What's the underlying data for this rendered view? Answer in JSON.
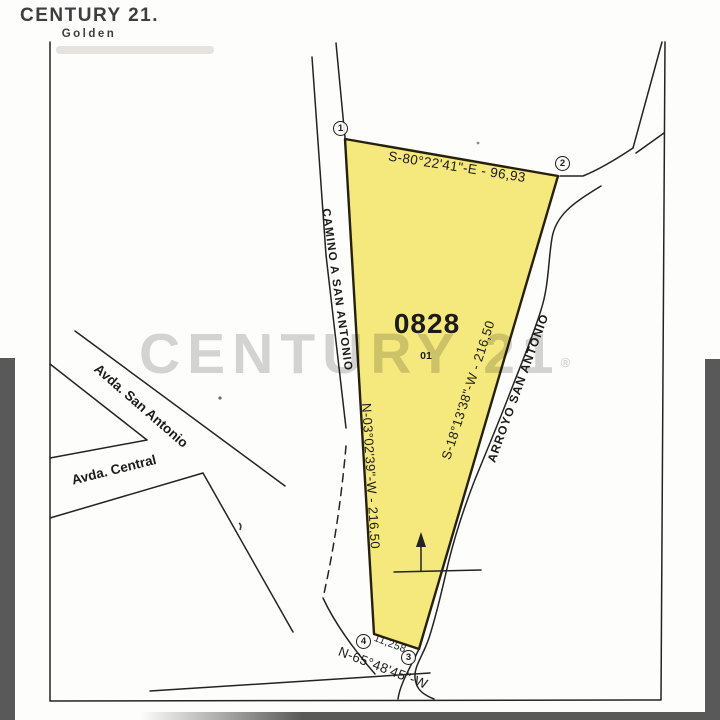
{
  "logo": {
    "brand": "CENTURY 21.",
    "office": "Golden"
  },
  "watermark": {
    "text": "CENTURY 21",
    "registered": "®"
  },
  "plot": {
    "number": "0828",
    "sub": "01"
  },
  "bearings": {
    "top": "S-80°22'41\"-E - 96,93",
    "left": "N-03°02'39\"-W - 216,50",
    "right": "S-18°13'38\"-W - 216,50",
    "bottom": "N-65°48'45\"-W",
    "bottom_length": "11,258"
  },
  "roads": {
    "camino": "CAMINO A SAN ANTONIO",
    "arroyo": "ARROYO SAN ANTONIO",
    "avda_san_antonio": "Avda. San Antonio",
    "avda_central": "Avda. Central"
  },
  "markers": [
    "1",
    "2",
    "3",
    "4"
  ],
  "colors": {
    "parcel_fill": "#F5E87C",
    "parcel_stroke": "#26200F",
    "map_ink": "#232323",
    "scan_bar": "#595959",
    "watermark_gray": "#9A9A9A",
    "logo_ink": "#3E3E40"
  }
}
